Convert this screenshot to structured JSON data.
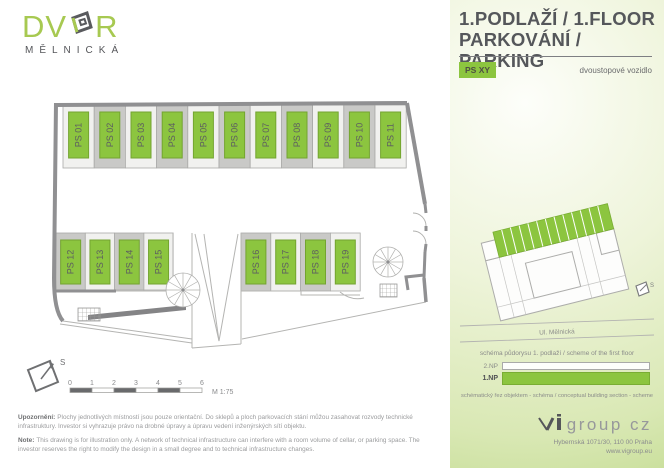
{
  "brand": {
    "name_prefix": "DV",
    "name_suffix": "R",
    "subtitle": "MĚLNICKÁ"
  },
  "header": {
    "title_line1": "1.PODLAŽÍ / 1.FLOOR",
    "title_line2": "PARKOVÁNÍ / PARKING"
  },
  "legend": {
    "badge": "PS XY",
    "description": "dvoustopové vozidlo"
  },
  "plan": {
    "spaces": [
      "PS 01",
      "PS 02",
      "PS 03",
      "PS 04",
      "PS 05",
      "PS 06",
      "PS 07",
      "PS 08",
      "PS 09",
      "PS 10",
      "PS 11",
      "PS 12",
      "PS 13",
      "PS 14",
      "PS 15",
      "PS 16",
      "PS 17",
      "PS 18",
      "PS 19"
    ],
    "north_label": "S"
  },
  "scale_bar": {
    "ticks": [
      "0",
      "1",
      "2",
      "3",
      "4",
      "5",
      "6"
    ],
    "label": "M 1:75"
  },
  "schema": {
    "street": "Ul. Mělnická",
    "north_label": "S",
    "caption_top": "schéma půdorysu 1. podlaží / scheme of the first floor",
    "caption_bottom": "schématický řez objektem - schéma / conceptual building section - scheme",
    "section_levels": [
      {
        "label": "2.NP",
        "highlight": false
      },
      {
        "label": "1.NP",
        "highlight": true
      }
    ]
  },
  "notes": {
    "cz_label": "Upozornění:",
    "cz_text": "Plochy jednotlivých místností jsou pouze orientační. Do sklepů a ploch parkovacích stání můžou zasahovat rozvody technické infrastruktury. Investor si vyhrazuje právo na drobné úpravy a úpravu vedení inženýrských sítí objektu.",
    "en_label": "Note:",
    "en_text": "This drawing is for illustration only. A network of technical infrastructure can interfere with a room volume of cellar, or parking space. The investor reserves the right to modify the design in a small degree and to technical infrastructure changes."
  },
  "footer": {
    "logo": "group cz",
    "address": "Hybernská 1071/30, 110 00 Praha",
    "website": "www.vigroup.eu"
  },
  "colors": {
    "green": "#8cc53f",
    "green_border": "#73a430",
    "stall_dark": "#c9c9c7",
    "stall_light": "#f1f1ef",
    "wall": "#909092",
    "title_text": "#55575b"
  }
}
